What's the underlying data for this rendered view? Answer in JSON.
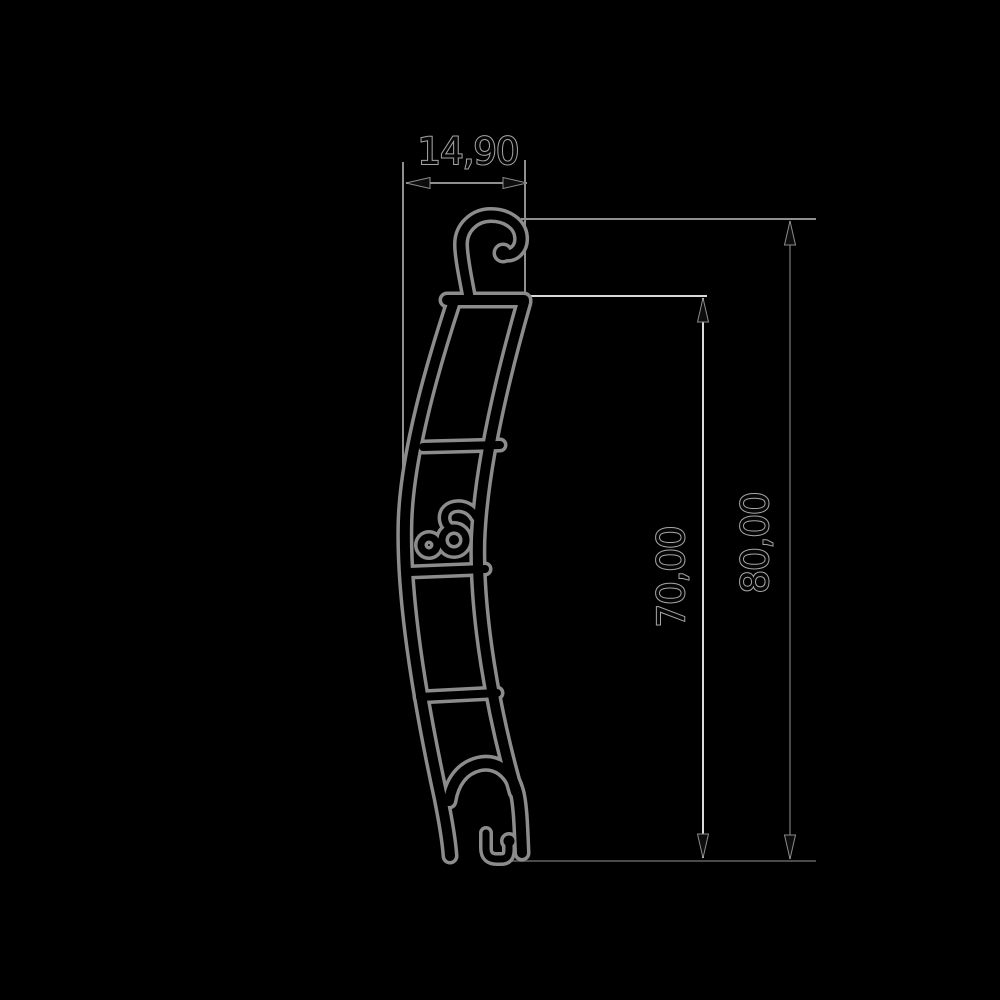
{
  "drawing": {
    "type": "technical-profile-cross-section",
    "description": "Roller shutter slat profile cross-section with dimension annotations",
    "labels": {
      "width": "14,90",
      "inner_height": "70,00",
      "outer_height": "80,00"
    },
    "colors": {
      "background": "#000000",
      "ink": "#000000",
      "halo": "#8c8c8c",
      "dim_line": "#8f8f8f",
      "dim_line_bright": "#d9d9d9",
      "dim_line_dim": "#4a4a4a",
      "arrow_fill": "#0d0d0d",
      "text_fill": "#060606",
      "text_outline": "#a6a6a6"
    }
  }
}
